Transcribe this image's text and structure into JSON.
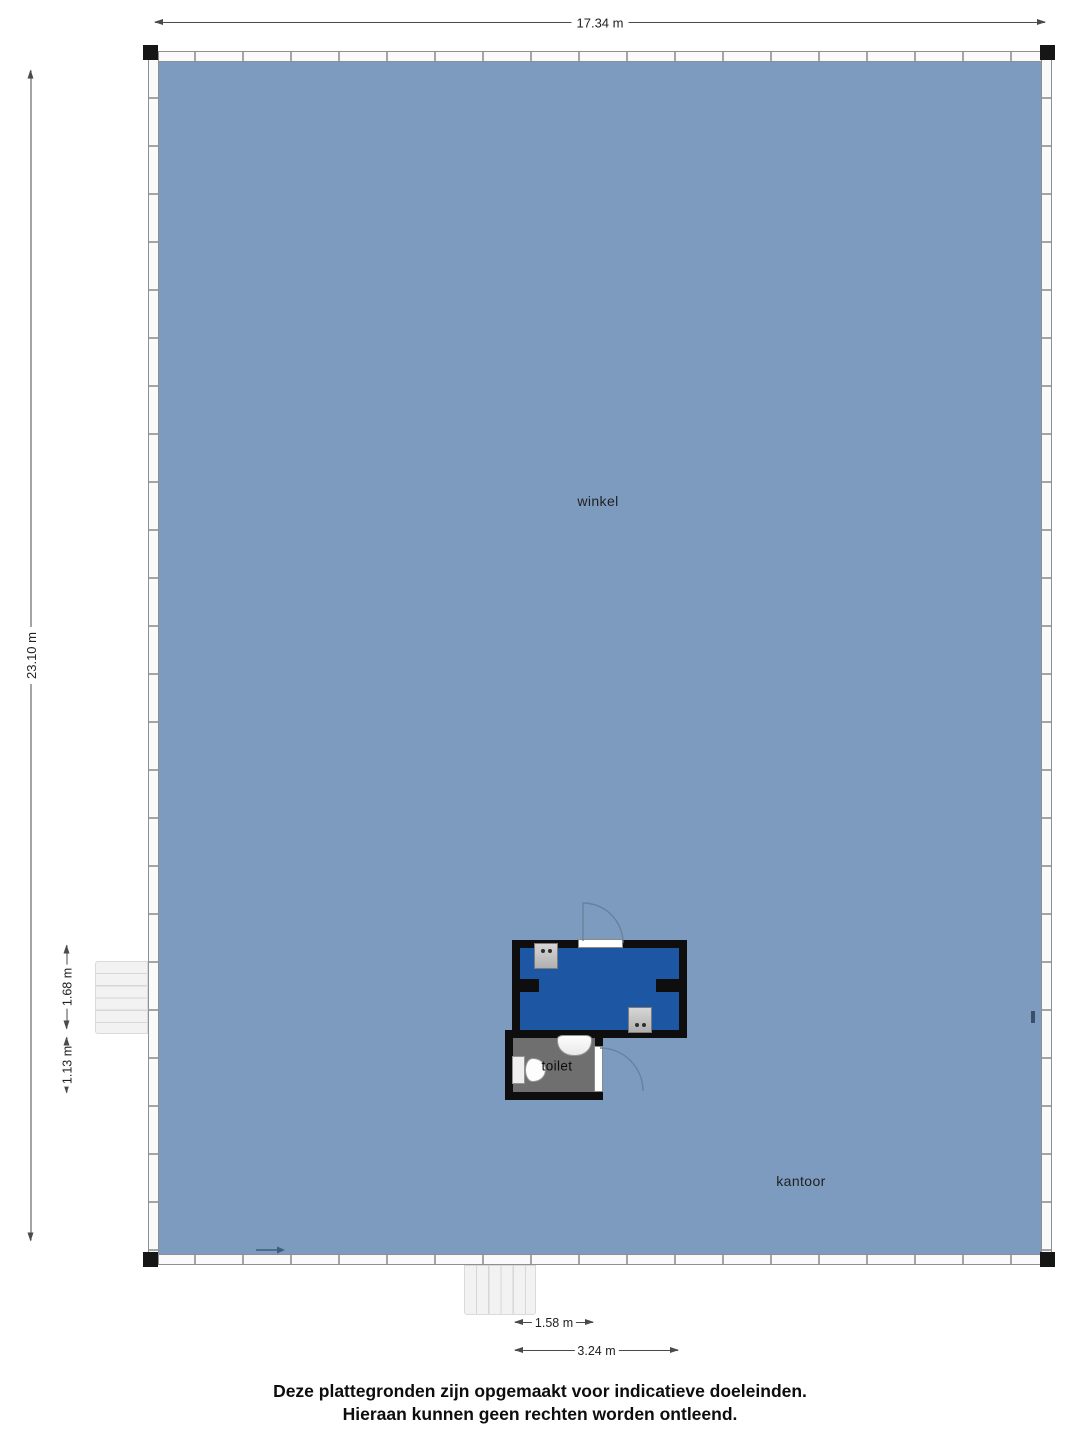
{
  "plan": {
    "rooms": {
      "winkel": "winkel",
      "kantoor": "kantoor",
      "toilet": "toilet"
    },
    "dimensions": {
      "width_total": "17.34 m",
      "height_total": "23.10 m",
      "stairs_left_upper": "1.68 m",
      "stairs_left_lower": "1.13 m",
      "bottom_stairs": "1.58 m",
      "bottom_entrance": "3.24 m"
    },
    "colors": {
      "floor": "#7d9bbf",
      "storage": "#1d56a3",
      "toiletFloor": "#6f6f6f",
      "wall": "#0e0e0e",
      "doorArc": "#66829d",
      "entryArrow": "#3f5d7d"
    }
  },
  "footer": {
    "line1": "Deze plattegronden zijn opgemaakt voor indicatieve doeleinden.",
    "line2": "Hieraan kunnen geen rechten worden ontleend."
  }
}
